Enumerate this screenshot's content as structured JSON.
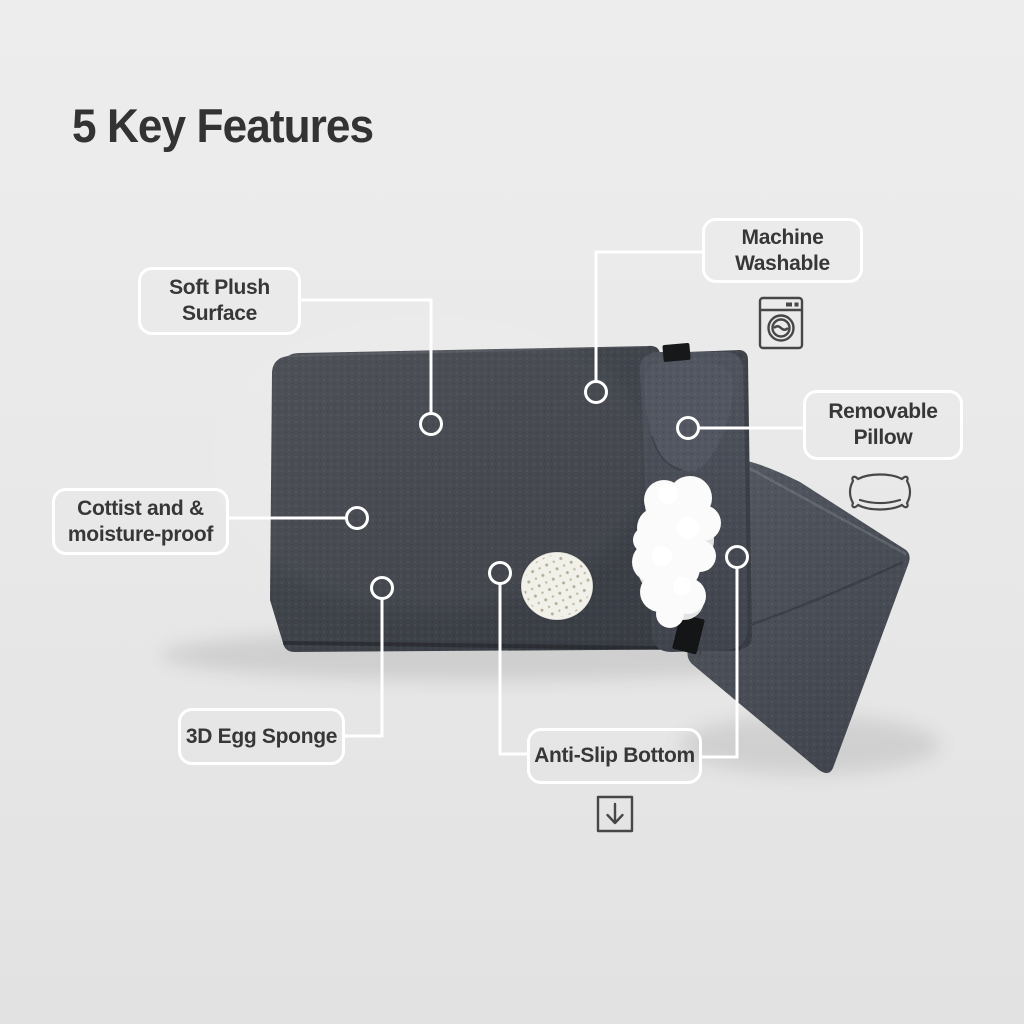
{
  "page": {
    "title": "5 Key Features"
  },
  "features": [
    {
      "name": "soft-plush-surface",
      "line1": "Soft Plush",
      "line2": "Surface"
    },
    {
      "name": "machine-washable",
      "line1": "Machine",
      "line2": "Washable",
      "icon": "washing-machine-icon"
    },
    {
      "name": "removable-pillow",
      "line1": "Removable",
      "line2": "Pillow",
      "icon": "pillow-icon"
    },
    {
      "name": "moisture-proof",
      "line1": "Cottist and &",
      "line2": "moisture-proof"
    },
    {
      "name": "egg-sponge",
      "line1": "3D Egg Sponge",
      "line2": ""
    },
    {
      "name": "anti-slip-bottom",
      "line1": "Anti-Slip Bottom",
      "line2": "",
      "icon": "down-arrow-icon"
    }
  ],
  "colors": {
    "background": "#e9e9e9",
    "title_text": "#333333",
    "callout_border": "#ffffff",
    "callout_text": "#373737",
    "connector": "#ffffff",
    "mat": "#3e424a",
    "pillow": "#4a4e57",
    "blanket": "#4d525b",
    "stuffing": "#fbfbfb",
    "sponge_sample": "#f1f0e9",
    "icon_stroke": "#474747"
  }
}
